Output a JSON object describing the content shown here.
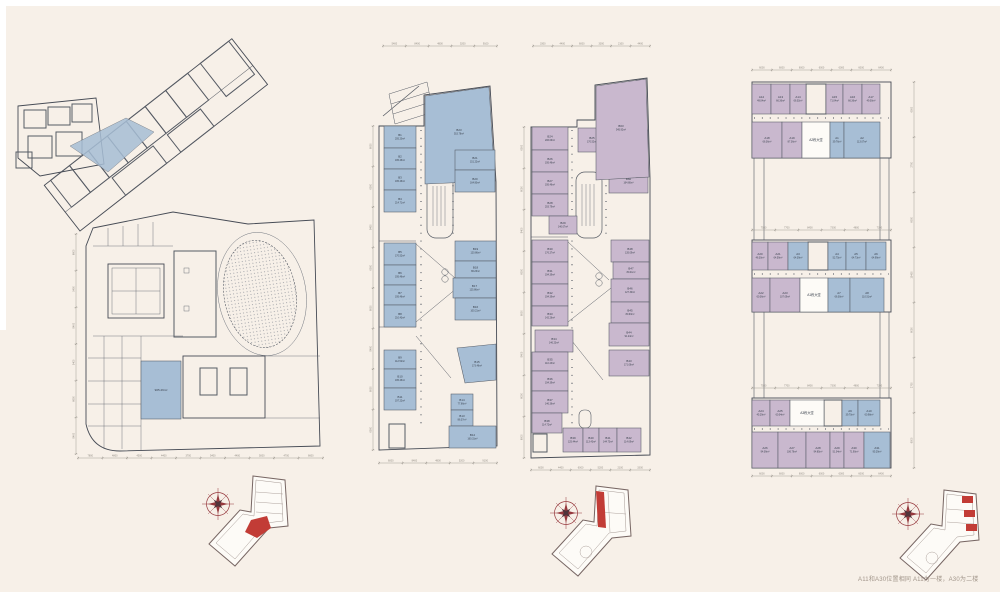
{
  "caption": "A11和A30位置相同  A11为一楼，A30为二楼",
  "colors": {
    "blue": "#a7bed5",
    "purple": "#c9b8ce",
    "white": "#fdfbf7",
    "line": "#565b64",
    "label": "#39404c",
    "dim": "#8f8a82",
    "red": "#b93a36",
    "compass": "#96383d",
    "background": "#f7f0e8"
  },
  "plans": [
    {
      "id": "site",
      "title": "site ground floor plan",
      "rooms": [
        {
          "c": "",
          "a": "905.29m²",
          "x": 133,
          "y": 355,
          "w": 40,
          "h": 58,
          "f": "blue"
        }
      ],
      "dims": [
        {
          "o": "h",
          "x": 70,
          "y": 452,
          "len": 245,
          "labels": [
            "7800",
            "4800",
            "4500",
            "4400",
            "3700",
            "5400",
            "4400",
            "5000",
            "4700",
            "6600"
          ]
        },
        {
          "o": "v",
          "x": 68,
          "y": 228,
          "len": 220,
          "labels": [
            "6600",
            "5400",
            "8400",
            "5400",
            "6600",
            "8400"
          ]
        }
      ]
    },
    {
      "id": "b-east",
      "title": "B block first floor",
      "rooms": [
        {
          "c": "B1",
          "a": "205.20m²",
          "x": 15,
          "y": 100,
          "w": 32,
          "h": 22,
          "f": "blue"
        },
        {
          "c": "B2",
          "a": "195.46m²",
          "x": 15,
          "y": 122,
          "w": 32,
          "h": 21,
          "f": "blue"
        },
        {
          "c": "B3",
          "a": "195.46m²",
          "x": 15,
          "y": 143,
          "w": 32,
          "h": 21,
          "f": "blue"
        },
        {
          "c": "B4",
          "a": "214.71m²",
          "x": 15,
          "y": 164,
          "w": 32,
          "h": 22,
          "f": "blue"
        },
        {
          "c": "B5",
          "a": "170.52m²",
          "x": 15,
          "y": 217,
          "w": 32,
          "h": 22,
          "f": "blue"
        },
        {
          "c": "B6",
          "a": "195.46m²",
          "x": 15,
          "y": 239,
          "w": 32,
          "h": 20,
          "f": "blue"
        },
        {
          "c": "B7",
          "a": "195.46m²",
          "x": 15,
          "y": 259,
          "w": 32,
          "h": 20,
          "f": "blue"
        },
        {
          "c": "B8",
          "a": "210.43m²",
          "x": 15,
          "y": 279,
          "w": 32,
          "h": 22,
          "f": "blue"
        },
        {
          "c": "B9",
          "a": "112.52m²",
          "x": 15,
          "y": 324,
          "w": 32,
          "h": 19,
          "f": "blue"
        },
        {
          "c": "B10",
          "a": "195.46m²",
          "x": 15,
          "y": 343,
          "w": 32,
          "h": 19,
          "f": "blue"
        },
        {
          "c": "B11",
          "a": "197.22m²",
          "x": 15,
          "y": 362,
          "w": 32,
          "h": 22,
          "f": "blue"
        },
        {
          "c": "B23",
          "a": "515.78m²",
          "poly": "56,70 120,61 126,155 56,158",
          "lx": 90,
          "ly": 106,
          "f": "blue"
        },
        {
          "c": "B21",
          "a": "151.22m²",
          "x": 86,
          "y": 124,
          "w": 40,
          "h": 20,
          "f": "blue"
        },
        {
          "c": "B20",
          "a": "164.80m²",
          "x": 86,
          "y": 144,
          "w": 40,
          "h": 22,
          "f": "blue"
        },
        {
          "c": "B19",
          "a": "120.86m²",
          "x": 86,
          "y": 215,
          "w": 41,
          "h": 20,
          "f": "blue"
        },
        {
          "c": "B18",
          "a": "86.26m²",
          "x": 86,
          "y": 235,
          "w": 41,
          "h": 17,
          "f": "blue"
        },
        {
          "c": "B17",
          "a": "125.86m²",
          "x": 84,
          "y": 252,
          "w": 43,
          "h": 20,
          "f": "blue"
        },
        {
          "c": "B16",
          "a": "100.21m²",
          "x": 86,
          "y": 272,
          "w": 41,
          "h": 22,
          "f": "blue"
        },
        {
          "c": "B15",
          "a": "173.46m²",
          "poly": "88,322 127,318 127,354 96,357",
          "lx": 108,
          "ly": 338,
          "f": "blue"
        },
        {
          "c": "B14",
          "a": "77.66m²",
          "x": 82,
          "y": 368,
          "w": 22,
          "h": 16,
          "f": "blue"
        },
        {
          "c": "B13",
          "a": "86.37m²",
          "x": 82,
          "y": 384,
          "w": 22,
          "h": 16,
          "f": "blue"
        },
        {
          "c": "B12",
          "a": "160.31m²",
          "x": 80,
          "y": 400,
          "w": 47,
          "h": 22,
          "f": "blue"
        }
      ],
      "dims": [
        {
          "o": "h",
          "x": 14,
          "y": 20,
          "len": 114,
          "labels": [
            "5400",
            "8400",
            "4800",
            "5200",
            "9100"
          ]
        },
        {
          "o": "h",
          "x": 10,
          "y": 437,
          "len": 118,
          "labels": [
            "6000",
            "8400",
            "4800",
            "5200",
            "9100"
          ]
        },
        {
          "o": "v",
          "x": 4,
          "y": 100,
          "len": 324,
          "labels": [
            "6000",
            "6000",
            "8400",
            "6000",
            "6000",
            "8400",
            "6000",
            "6000"
          ]
        }
      ]
    },
    {
      "id": "b-west",
      "title": "B block second floor",
      "rooms": [
        {
          "c": "B24",
          "a": "206.09m²",
          "x": 13,
          "y": 97,
          "w": 36,
          "h": 23,
          "f": "purple"
        },
        {
          "c": "B26",
          "a": "195.46m²",
          "x": 13,
          "y": 120,
          "w": 36,
          "h": 22,
          "f": "purple"
        },
        {
          "c": "B27",
          "a": "195.46m²",
          "x": 13,
          "y": 142,
          "w": 36,
          "h": 22,
          "f": "purple"
        },
        {
          "c": "B28",
          "a": "203.79m²",
          "x": 13,
          "y": 164,
          "w": 36,
          "h": 22,
          "f": "purple"
        },
        {
          "c": "B29",
          "a": "140.07m²",
          "x": 30,
          "y": 186,
          "w": 28,
          "h": 18,
          "f": "purple"
        },
        {
          "c": "B25",
          "a": "170.52m²",
          "x": 59,
          "y": 98,
          "w": 28,
          "h": 24,
          "f": "purple"
        },
        {
          "c": "B62",
          "a": "75.36m²",
          "x": 93,
          "y": 100,
          "w": 36,
          "h": 17,
          "f": "purple"
        },
        {
          "c": "B61",
          "a": "195.46m²",
          "x": 92,
          "y": 117,
          "w": 37,
          "h": 22,
          "f": "purple"
        },
        {
          "c": "B60",
          "a": "164.80m²",
          "x": 90,
          "y": 139,
          "w": 39,
          "h": 24,
          "f": "purple"
        },
        {
          "c": "B63",
          "a": "545.92m²",
          "poly": "77,56 127,49 130,147 77,150",
          "lx": 102,
          "ly": 98,
          "f": "purple"
        },
        {
          "c": "B30",
          "a": "176.27m²",
          "x": 13,
          "y": 210,
          "w": 36,
          "h": 22,
          "f": "purple"
        },
        {
          "c": "B31",
          "a": "194.39m²",
          "x": 13,
          "y": 232,
          "w": 36,
          "h": 22,
          "f": "purple"
        },
        {
          "c": "B32",
          "a": "194.39m²",
          "x": 13,
          "y": 254,
          "w": 36,
          "h": 22,
          "f": "purple"
        },
        {
          "c": "B33",
          "a": "142.26m²",
          "x": 13,
          "y": 276,
          "w": 36,
          "h": 20,
          "f": "purple"
        },
        {
          "c": "B34",
          "a": "146.23m²",
          "x": 16,
          "y": 300,
          "w": 38,
          "h": 22,
          "f": "purple"
        },
        {
          "c": "B35",
          "a": "110.43m²",
          "x": 13,
          "y": 322,
          "w": 36,
          "h": 19,
          "f": "purple"
        },
        {
          "c": "B36",
          "a": "194.39m²",
          "x": 13,
          "y": 341,
          "w": 36,
          "h": 20,
          "f": "purple"
        },
        {
          "c": "B37",
          "a": "146.36m²",
          "x": 13,
          "y": 361,
          "w": 36,
          "h": 22,
          "f": "purple"
        },
        {
          "c": "B38",
          "a": "114.72m²",
          "x": 13,
          "y": 383,
          "w": 30,
          "h": 20,
          "f": "purple"
        },
        {
          "c": "B39",
          "a": "125.44m²",
          "x": 44,
          "y": 398,
          "w": 20,
          "h": 24,
          "f": "purple"
        },
        {
          "c": "B40",
          "a": "113.43m²",
          "x": 64,
          "y": 398,
          "w": 16,
          "h": 24,
          "f": "purple"
        },
        {
          "c": "B41",
          "a": "144.73m²",
          "x": 80,
          "y": 398,
          "w": 18,
          "h": 24,
          "f": "purple"
        },
        {
          "c": "B42",
          "a": "114.69m²",
          "x": 98,
          "y": 398,
          "w": 24,
          "h": 24,
          "f": "purple"
        },
        {
          "c": "B48",
          "a": "135.09m²",
          "x": 92,
          "y": 210,
          "w": 38,
          "h": 22,
          "f": "purple"
        },
        {
          "c": "B47",
          "a": "80.41m²",
          "x": 94,
          "y": 232,
          "w": 36,
          "h": 17,
          "f": "purple"
        },
        {
          "c": "B46",
          "a": "127.30m²",
          "x": 92,
          "y": 249,
          "w": 38,
          "h": 23,
          "f": "purple"
        },
        {
          "c": "B45",
          "a": "80.93m²",
          "x": 92,
          "y": 272,
          "w": 38,
          "h": 21,
          "f": "purple"
        },
        {
          "c": "B44",
          "a": "91.24m²",
          "x": 90,
          "y": 293,
          "w": 40,
          "h": 23,
          "f": "purple"
        },
        {
          "c": "B43",
          "a": "171.06m²",
          "x": 90,
          "y": 320,
          "w": 40,
          "h": 26,
          "f": "purple"
        }
      ],
      "dims": [
        {
          "o": "h",
          "x": 14,
          "y": 16,
          "len": 117,
          "labels": [
            "3300",
            "4400",
            "6000",
            "3300",
            "2100",
            "4400"
          ]
        },
        {
          "o": "h",
          "x": 12,
          "y": 440,
          "len": 119,
          "labels": [
            "6000",
            "4400",
            "6000",
            "5200",
            "2100",
            "3300"
          ]
        },
        {
          "o": "v",
          "x": 5,
          "y": 97,
          "len": 331,
          "labels": [
            "6000",
            "6000",
            "8400",
            "6000",
            "6000",
            "8400",
            "6000",
            "6000"
          ]
        }
      ]
    },
    {
      "id": "a",
      "title": "A blocks plan",
      "rooms": [
        {
          "c": "A12",
          "a": "49.04m²",
          "x": 10,
          "y": 26,
          "w": 19,
          "h": 30,
          "f": "purple"
        },
        {
          "c": "A13",
          "a": "66.36m²",
          "x": 29,
          "y": 26,
          "w": 19,
          "h": 30,
          "f": "purple"
        },
        {
          "c": "A14",
          "a": "66.02m²",
          "x": 48,
          "y": 26,
          "w": 16,
          "h": 30,
          "f": "purple"
        },
        {
          "c": "A15",
          "a": "71.04m²",
          "x": 84,
          "y": 26,
          "w": 17,
          "h": 30,
          "f": "purple"
        },
        {
          "c": "A16",
          "a": "66.36m²",
          "x": 101,
          "y": 26,
          "w": 19,
          "h": 30,
          "f": "purple"
        },
        {
          "c": "A17",
          "a": "49.00m²",
          "x": 120,
          "y": 26,
          "w": 18,
          "h": 30,
          "f": "purple"
        },
        {
          "c": "A18",
          "a": "66.36m²",
          "x": 10,
          "y": 64,
          "w": 30,
          "h": 36,
          "f": "purple"
        },
        {
          "c": "A19",
          "a": "87.36m²",
          "x": 40,
          "y": 64,
          "w": 20,
          "h": 36,
          "f": "purple"
        },
        {
          "c": "A2栋大堂",
          "a": "",
          "x": 60,
          "y": 64,
          "w": 28,
          "h": 36,
          "f": "white",
          "fs": 3.2
        },
        {
          "c": "A1",
          "a": "39.76m²",
          "x": 88,
          "y": 64,
          "w": 14,
          "h": 36,
          "f": "blue"
        },
        {
          "c": "A2",
          "a": "113.07m²",
          "x": 102,
          "y": 64,
          "w": 36,
          "h": 36,
          "f": "blue"
        },
        {
          "c": "A20",
          "a": "46.30m²",
          "x": 10,
          "y": 184,
          "w": 16,
          "h": 28,
          "f": "purple"
        },
        {
          "c": "A21",
          "a": "64.59m²",
          "x": 26,
          "y": 184,
          "w": 20,
          "h": 28,
          "f": "purple"
        },
        {
          "c": "A3",
          "a": "64.39m²",
          "x": 46,
          "y": 184,
          "w": 20,
          "h": 28,
          "f": "blue"
        },
        {
          "c": "A4",
          "a": "52.75m²",
          "x": 86,
          "y": 184,
          "w": 18,
          "h": 28,
          "f": "blue"
        },
        {
          "c": "A5",
          "a": "64.73m²",
          "x": 104,
          "y": 184,
          "w": 20,
          "h": 28,
          "f": "blue"
        },
        {
          "c": "A6",
          "a": "64.99m²",
          "x": 124,
          "y": 184,
          "w": 20,
          "h": 28,
          "f": "blue"
        },
        {
          "c": "A22",
          "a": "60.36m²",
          "x": 10,
          "y": 220,
          "w": 18,
          "h": 34,
          "f": "purple"
        },
        {
          "c": "A23",
          "a": "107.09m²",
          "x": 28,
          "y": 220,
          "w": 30,
          "h": 34,
          "f": "purple"
        },
        {
          "c": "A1栋大堂",
          "a": "",
          "x": 58,
          "y": 220,
          "w": 28,
          "h": 34,
          "f": "white",
          "fs": 3.2
        },
        {
          "c": "A7",
          "a": "66.00m²",
          "x": 86,
          "y": 220,
          "w": 22,
          "h": 34,
          "f": "blue"
        },
        {
          "c": "A8",
          "a": "110.51m²",
          "x": 108,
          "y": 220,
          "w": 34,
          "h": 34,
          "f": "blue"
        },
        {
          "c": "A24",
          "a": "45.29m²",
          "x": 10,
          "y": 342,
          "w": 18,
          "h": 26,
          "f": "purple"
        },
        {
          "c": "A25",
          "a": "60.04m²",
          "x": 28,
          "y": 342,
          "w": 20,
          "h": 26,
          "f": "purple"
        },
        {
          "c": "A3栋大堂",
          "a": "",
          "x": 48,
          "y": 342,
          "w": 34,
          "h": 26,
          "f": "white",
          "fs": 3.2
        },
        {
          "c": "A9",
          "a": "39.70m²",
          "x": 100,
          "y": 342,
          "w": 16,
          "h": 26,
          "f": "blue"
        },
        {
          "c": "A10",
          "a": "60.98m²",
          "x": 116,
          "y": 342,
          "w": 22,
          "h": 26,
          "f": "blue"
        },
        {
          "c": "A26",
          "a": "94.09m²",
          "x": 10,
          "y": 374,
          "w": 26,
          "h": 36,
          "f": "purple"
        },
        {
          "c": "A27",
          "a": "106.76m²",
          "x": 36,
          "y": 374,
          "w": 28,
          "h": 36,
          "f": "purple"
        },
        {
          "c": "A28",
          "a": "94.85m²",
          "x": 64,
          "y": 374,
          "w": 24,
          "h": 36,
          "f": "purple"
        },
        {
          "c": "A29",
          "a": "51.04m²",
          "x": 88,
          "y": 374,
          "w": 14,
          "h": 36,
          "f": "purple"
        },
        {
          "c": "A30",
          "a": "71.90m²",
          "x": 102,
          "y": 374,
          "w": 20,
          "h": 36,
          "f": "purple"
        },
        {
          "c": "A31",
          "a": "95.29m²",
          "x": 122,
          "y": 374,
          "w": 26,
          "h": 36,
          "f": "blue"
        }
      ],
      "dims": [
        {
          "o": "h",
          "x": 10,
          "y": 12,
          "len": 139,
          "labels": [
            "6000",
            "6000",
            "6000",
            "6000",
            "6000",
            "6000",
            "6400"
          ]
        },
        {
          "o": "h",
          "x": 10,
          "y": 172,
          "len": 139,
          "labels": [
            "7500",
            "7700",
            "8400",
            "7300",
            "4800",
            "7300"
          ]
        },
        {
          "o": "h",
          "x": 10,
          "y": 330,
          "len": 139,
          "labels": [
            "7500",
            "7700",
            "8400",
            "7300",
            "4800",
            "7300"
          ]
        },
        {
          "o": "h",
          "x": 10,
          "y": 418,
          "len": 139,
          "labels": [
            "6000",
            "6000",
            "6000",
            "6000",
            "6000",
            "6000",
            "6400"
          ]
        },
        {
          "o": "v",
          "x": 172,
          "y": 24,
          "len": 386,
          "labels": [
            "6000",
            "2700",
            "6000",
            "15400",
            "6000",
            "2700",
            "6000"
          ]
        }
      ]
    }
  ]
}
